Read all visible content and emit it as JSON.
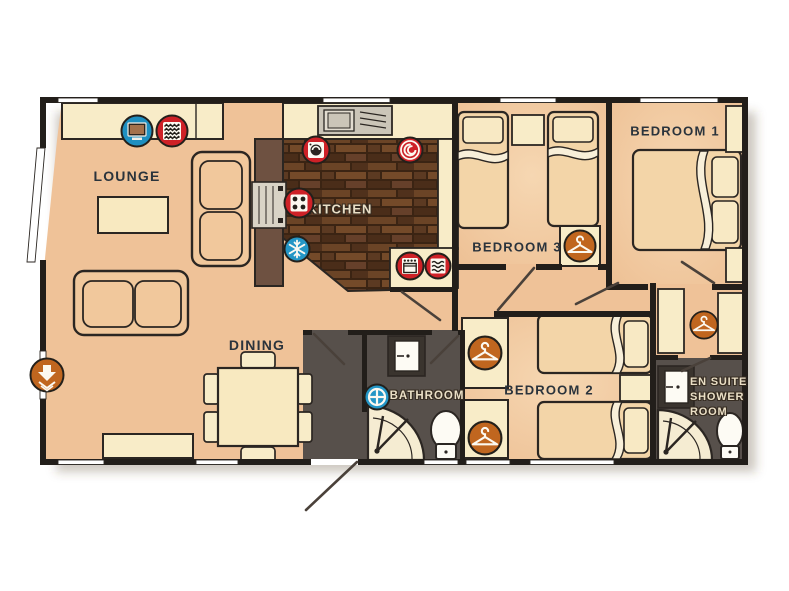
{
  "plan": {
    "type": "holiday-home-floorplan",
    "rooms": {
      "lounge": "LOUNGE",
      "kitchen": "KITCHEN",
      "dining": "DINING",
      "bathroom": "BATHROOM",
      "bedroom1": "BEDROOM 1",
      "bedroom2": "BEDROOM 2",
      "bedroom3": "BEDROOM 3",
      "ensuite_line1": "EN SUITE",
      "ensuite_line2": "SHOWER",
      "ensuite_line3": "ROOM"
    },
    "legend_icons": [
      {
        "name": "tv-icon",
        "room": "lounge",
        "color": "#1E8FC0"
      },
      {
        "name": "fire-icon",
        "room": "lounge",
        "color": "#CE2127"
      },
      {
        "name": "washing-machine-icon",
        "room": "kitchen",
        "color": "#CE2127"
      },
      {
        "name": "microwave-icon",
        "room": "kitchen",
        "color": "#CE2127"
      },
      {
        "name": "hob-icon",
        "room": "kitchen",
        "color": "#CE2127"
      },
      {
        "name": "fridge-freezer-icon",
        "room": "kitchen",
        "color": "#2496C6"
      },
      {
        "name": "oven-icon",
        "room": "kitchen",
        "color": "#CE2127"
      },
      {
        "name": "heater-icon",
        "room": "kitchen",
        "color": "#CE2127"
      },
      {
        "name": "roof-vent-icon",
        "room": "bathroom",
        "color": "#2496C6"
      },
      {
        "name": "entrance-door-icon",
        "room": "lounge",
        "color": "#C0661F"
      },
      {
        "name": "wardrobe-hanger-icon",
        "room": "bedroom3",
        "color": "#C0661F"
      },
      {
        "name": "wardrobe-hanger-icon",
        "room": "bedroom2-upper",
        "color": "#C0661F"
      },
      {
        "name": "wardrobe-hanger-icon",
        "room": "bedroom2-lower",
        "color": "#C0661F"
      },
      {
        "name": "wardrobe-hanger-icon",
        "room": "dressing-area",
        "color": "#C0661F"
      }
    ],
    "colors": {
      "floor": "#EFC298",
      "furniture_cream": "#F8ECC8",
      "wall": "#221E1A",
      "kitchen_wood": "#56361F",
      "wet_room_floor": "#57504B",
      "icon_red": "#CE2127",
      "icon_blue": "#2496C6",
      "icon_orange": "#C0661F",
      "label_text": "#2A333C"
    }
  }
}
